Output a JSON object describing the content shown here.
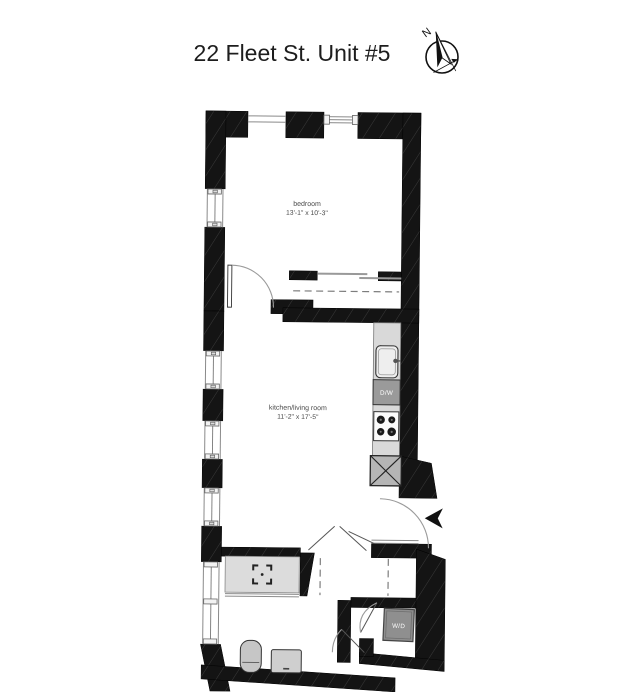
{
  "header": {
    "title": "22 Fleet St. Unit #5"
  },
  "compass": {
    "north_label": "N"
  },
  "rooms": {
    "bedroom": {
      "name": "bedroom",
      "dimensions": "13'-1\" x 10'-3\""
    },
    "kitchen_living": {
      "name": "kitchen/living room",
      "dimensions": "11'-2\" x 17'-5\""
    }
  },
  "appliances": {
    "dishwasher": "D/W",
    "washer_dryer": "W/D"
  },
  "colors": {
    "wall": "#141414",
    "wall_hatch": "#3a3a3a",
    "counter": "#d9d9d9",
    "appliance_box": "#9a9a9a",
    "laundry_box": "#8f8f8f",
    "refrigerator": "#b5b5b5",
    "fixture": "#c6c6c6",
    "sink": "#eeeeee",
    "line": "#8a8a8a",
    "title_text": "#1d1d1d",
    "label_text": "#4a4a4a"
  }
}
